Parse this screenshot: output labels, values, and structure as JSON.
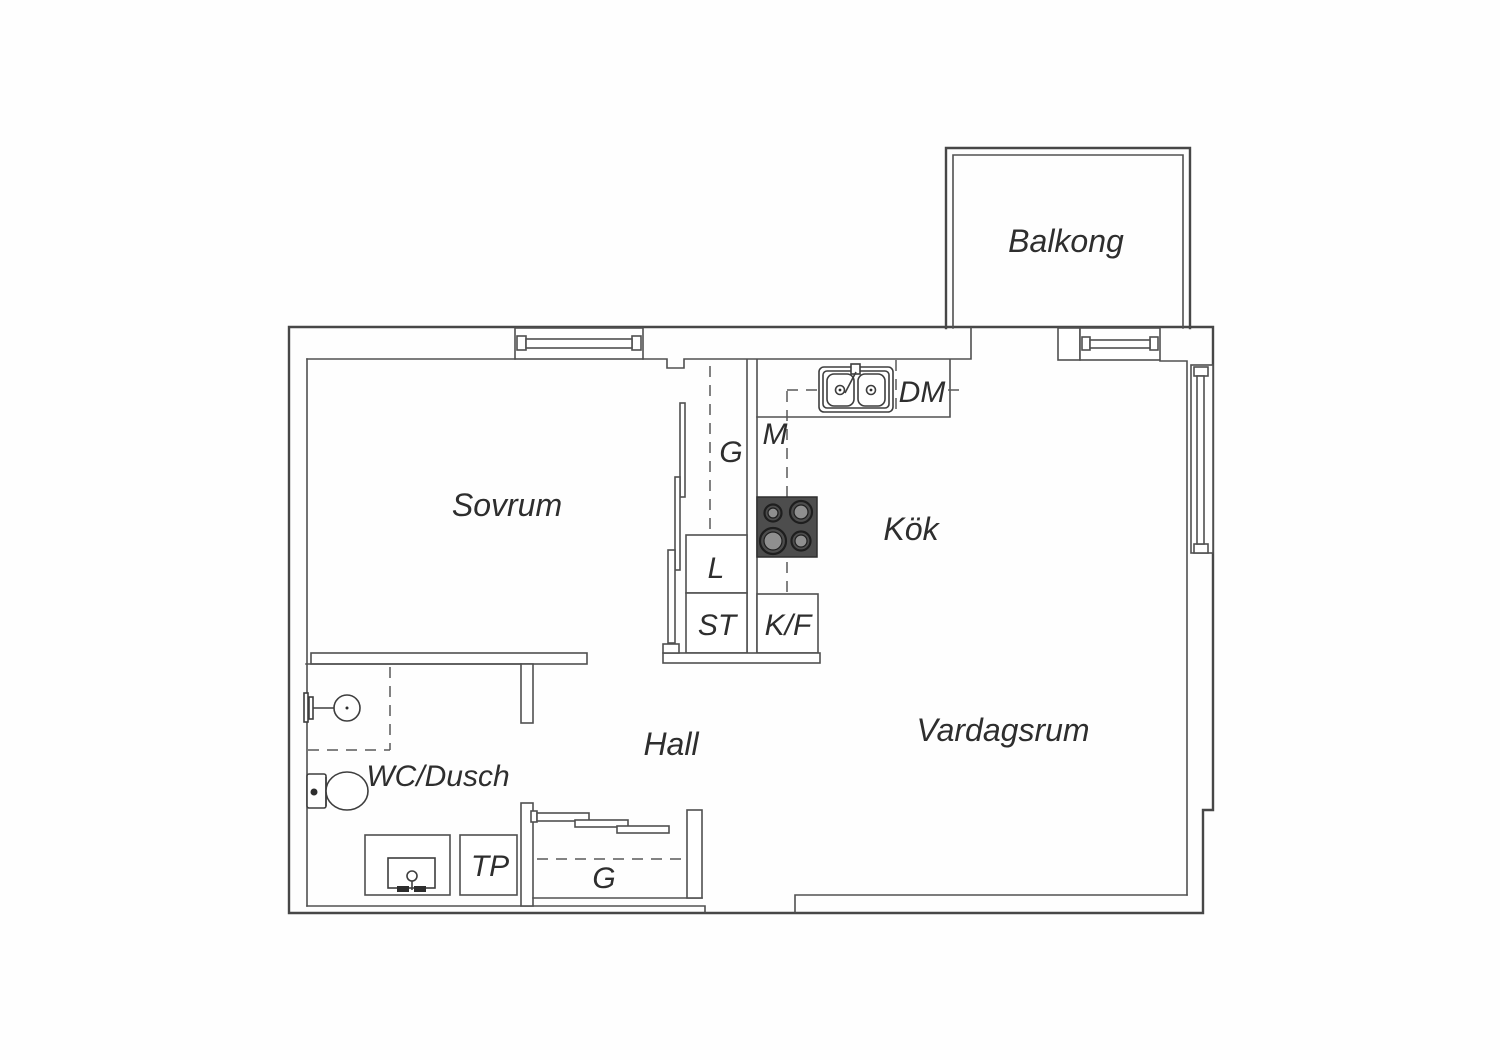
{
  "plan": {
    "rooms": {
      "balcony": "Balkong",
      "bedroom": "Sovrum",
      "kitchen": "Kök",
      "living_room": "Vardagsrum",
      "hall": "Hall",
      "bathroom": "WC/Dusch"
    },
    "closets": {
      "wardrobe_bedroom": "G",
      "linen_cabinet": "L",
      "cleaning_cabinet": "ST",
      "drying_cabinet": "TP",
      "wardrobe_hall": "G"
    },
    "appliances": {
      "dishwasher": "DM",
      "microwave": "M",
      "fridge_freezer": "K/F"
    },
    "colors": {
      "wall": "#474747",
      "text": "#2e2e2e",
      "stove_top": "#4d4d4d",
      "burner_disc": "#8f8f8f",
      "background": "#ffffff"
    }
  }
}
